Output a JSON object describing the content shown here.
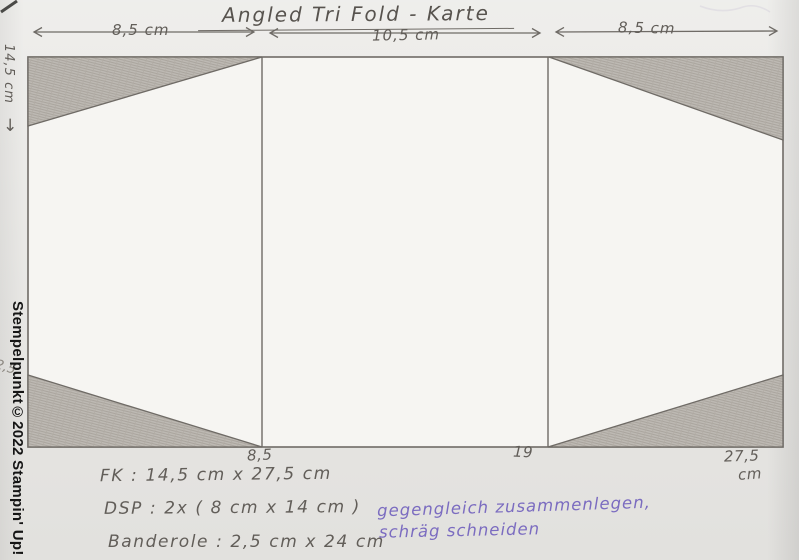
{
  "title": "Angled Tri Fold - Karte",
  "dimensions": {
    "panel_left_width": "8,5 cm",
    "panel_middle_width": "10,5 cm",
    "panel_right_width": "8,5 cm",
    "card_height": "14,5 cm",
    "height_arrow": "↓",
    "fold_mark_1": "8,5",
    "fold_mark_2": "19",
    "total_width": "27,5",
    "total_width_unit": "cm",
    "margin_note": "2,5"
  },
  "cutting_notes": {
    "fk": "FK : 14,5 cm x 27,5 cm",
    "dsp": "DSP : 2x ( 8 cm x 14 cm )",
    "banderole": "Banderole : 2,5 cm x 24 cm"
  },
  "instruction_note": {
    "line1": "gegengleich zusammenlegen,",
    "line2": "schräg schneiden"
  },
  "watermark": "Stempelpunkt©2022 Stampin' Up!",
  "colors": {
    "pencil": "#6f6b66",
    "ink_purple": "#7b6cc0",
    "shading": "#b8b4ae",
    "paper": "#e9e8e5"
  }
}
